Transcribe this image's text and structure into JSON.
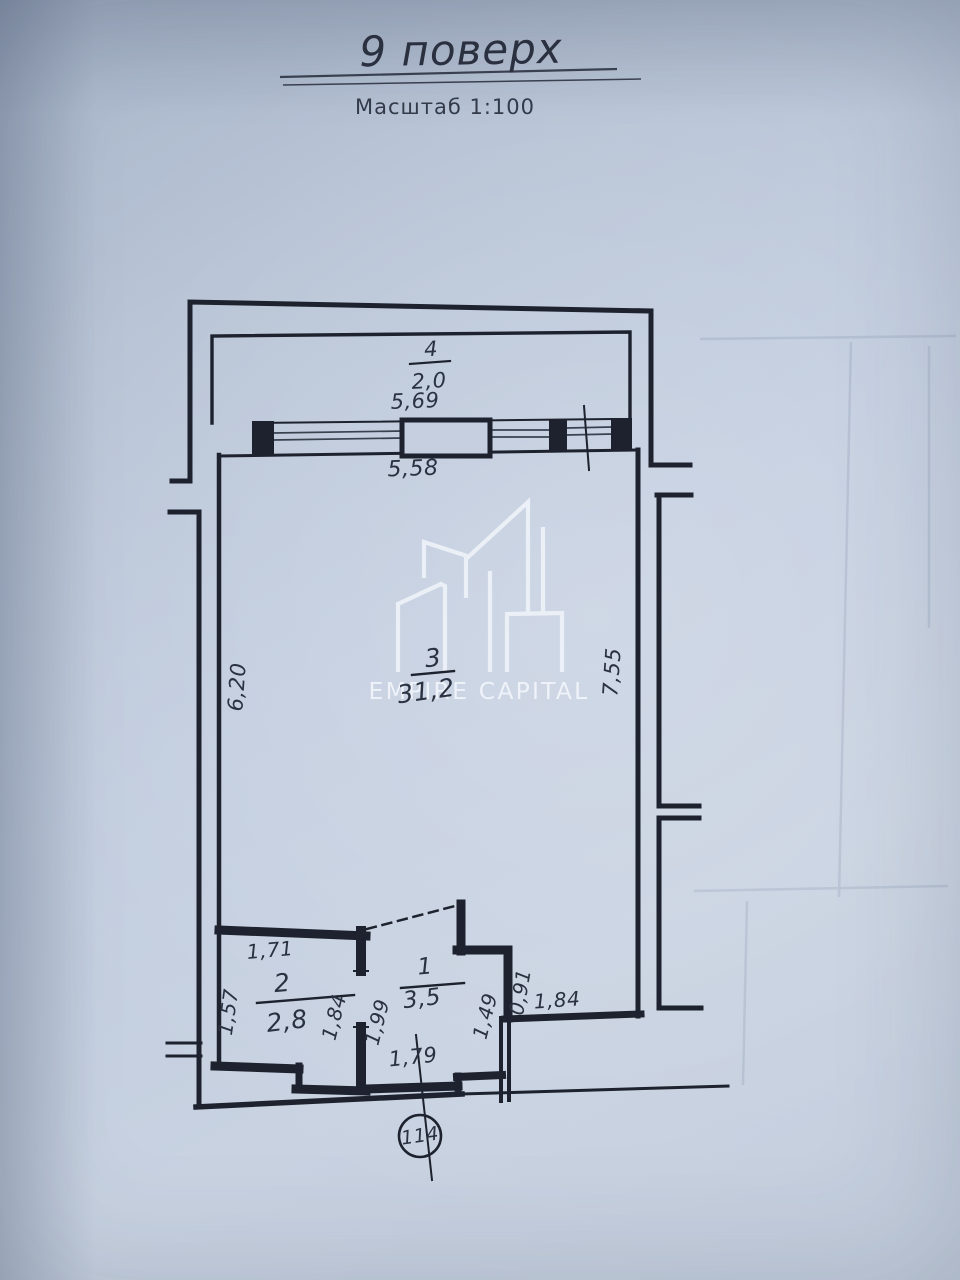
{
  "page": {
    "title": "9 поверх",
    "scale_label": "Масштаб 1:100"
  },
  "watermark": {
    "brand": "EMPIRE CAPITAL"
  },
  "callout": {
    "apartment_number": "114"
  },
  "rooms": {
    "balcony": {
      "number": "4",
      "area": "2,0"
    },
    "living": {
      "number": "3",
      "area": "31,2"
    },
    "bathroom": {
      "number": "2",
      "area": "2,8"
    },
    "hall": {
      "number": "1",
      "area": "3,5"
    }
  },
  "dimensions": {
    "balcony_width": "5,69",
    "living_width": "5,58",
    "left_side": "6,20",
    "right_side": "7,55",
    "bathroom_top": "1,71",
    "bathroom_left": "1,57",
    "bathroom_right": "1,84",
    "hall_left": "1,99",
    "hall_right": "1,49",
    "alcove_depth": "0,91",
    "alcove_width": "1,84",
    "entry_bottom": "1,79"
  },
  "colors": {
    "ink": "#1d222e",
    "paper": "#bfcadb",
    "watermark": "#f0f4fa"
  }
}
